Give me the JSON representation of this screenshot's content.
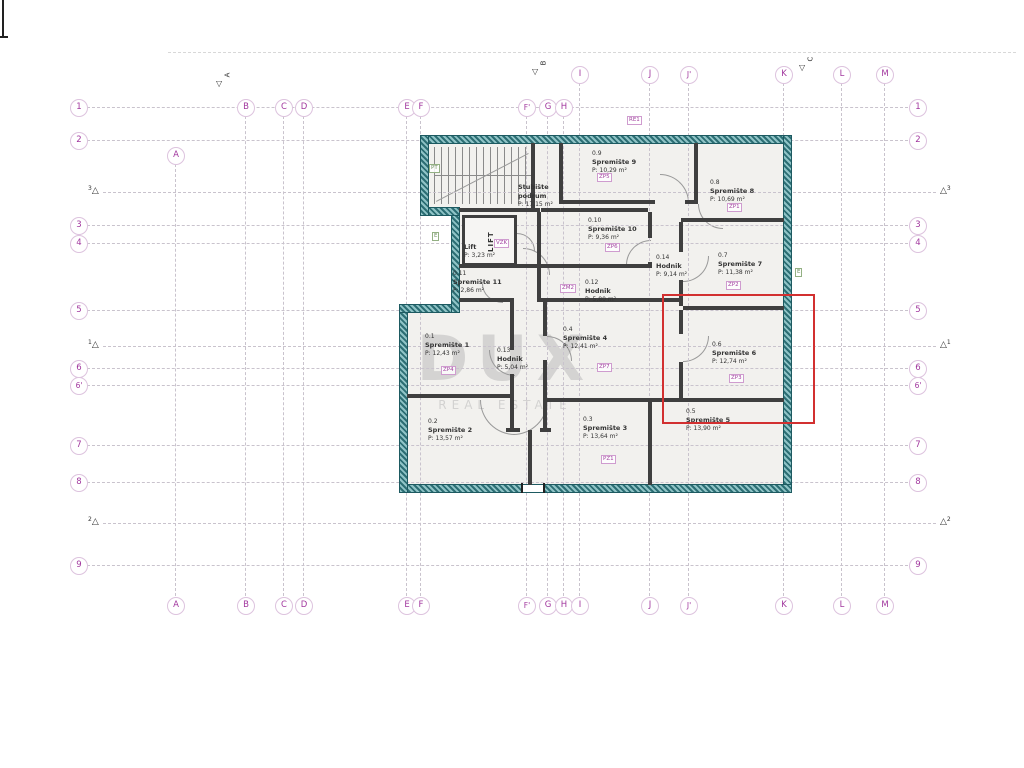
{
  "watermark": {
    "line1": "DUX",
    "line2": "REAL ESTATE"
  },
  "stairwell": {
    "line1": "Stubište",
    "line2": "podrum",
    "line3": "P: 17,15 m²"
  },
  "lift": {
    "name": "Lift",
    "area": "P: 3,23 m²",
    "shaft_label": "LIFT"
  },
  "highlight_color": "#d23030",
  "rooms": [
    {
      "id": "0.1",
      "name": "Spremište 1",
      "area": "P: 12,43 m²",
      "x": 425,
      "y": 333,
      "tag": "ZP4",
      "tx": 441,
      "ty": 366
    },
    {
      "id": "0.2",
      "name": "Spremište 2",
      "area": "P: 13,57 m²",
      "x": 428,
      "y": 418
    },
    {
      "id": "0.3",
      "name": "Spremište 3",
      "area": "P: 13,64 m²",
      "x": 583,
      "y": 416,
      "tag": "PZ1",
      "tx": 601,
      "ty": 455
    },
    {
      "id": "0.4",
      "name": "Spremište 4",
      "area": "P: 12,41 m²",
      "x": 563,
      "y": 326,
      "tag": "ZP7",
      "tx": 597,
      "ty": 363
    },
    {
      "id": "0.5",
      "name": "Spremište 5",
      "area": "P: 13,90 m²",
      "x": 686,
      "y": 408
    },
    {
      "id": "0.6",
      "name": "Spremište 6",
      "area": "P: 12,74 m²",
      "x": 712,
      "y": 341,
      "tag": "ZP3",
      "tx": 729,
      "ty": 374
    },
    {
      "id": "0.7",
      "name": "Spremište 7",
      "area": "P: 11,38 m²",
      "x": 718,
      "y": 252,
      "tag": "ZP2",
      "tx": 726,
      "ty": 281
    },
    {
      "id": "0.8",
      "name": "Spremište 8",
      "area": "P: 10,69 m²",
      "x": 710,
      "y": 179,
      "tag": "ZP1",
      "tx": 727,
      "ty": 203
    },
    {
      "id": "0.9",
      "name": "Spremište 9",
      "area": "P: 10,29 m²",
      "x": 592,
      "y": 150,
      "tag": "ZP5",
      "tx": 597,
      "ty": 173
    },
    {
      "id": "0.10",
      "name": "Spremište 10",
      "area": "P: 9,36 m²",
      "x": 588,
      "y": 217,
      "tag": "ZP6",
      "tx": 605,
      "ty": 243
    },
    {
      "id": "0.11",
      "name": "Spremište 11",
      "area": "P: 2,86 m²",
      "x": 453,
      "y": 270
    },
    {
      "id": "0.12",
      "name": "Hodnik",
      "area": "P: 5,80 m²",
      "x": 585,
      "y": 279
    },
    {
      "id": "0.13",
      "name": "Hodnik",
      "area": "P: 5,04 m²",
      "x": 497,
      "y": 347
    },
    {
      "id": "0.14",
      "name": "Hodnik",
      "area": "P: 9,14 m²",
      "x": 656,
      "y": 254
    }
  ],
  "wall_tags": [
    {
      "code": "RE1",
      "x": 627,
      "y": 116,
      "color": "purple"
    },
    {
      "code": "PT",
      "x": 429,
      "y": 164,
      "color": "green"
    },
    {
      "code": "E",
      "x": 432,
      "y": 232,
      "color": "green"
    },
    {
      "code": "ZM2",
      "x": 560,
      "y": 284,
      "color": "purple"
    },
    {
      "code": "VZK",
      "x": 494,
      "y": 239,
      "color": "purple"
    },
    {
      "code": "E",
      "x": 795,
      "y": 268,
      "color": "green"
    }
  ],
  "grid": {
    "columns": [
      {
        "label": "A",
        "x": 175,
        "top_y": 155
      },
      {
        "label": "B",
        "x": 245,
        "top_y": 107
      },
      {
        "label": "C",
        "x": 283,
        "top_y": 107
      },
      {
        "label": "D",
        "x": 303,
        "top_y": 107
      },
      {
        "label": "E",
        "x": 406,
        "top_y": 107
      },
      {
        "label": "F",
        "x": 420,
        "top_y": 107
      },
      {
        "label": "F'",
        "x": 526,
        "top_y": 107
      },
      {
        "label": "G",
        "x": 547,
        "top_y": 107
      },
      {
        "label": "H",
        "x": 563,
        "top_y": 107
      },
      {
        "label": "I",
        "x": 579,
        "top_y": 74
      },
      {
        "label": "J",
        "x": 649,
        "top_y": 74
      },
      {
        "label": "J'",
        "x": 688,
        "top_y": 74
      },
      {
        "label": "K",
        "x": 783,
        "top_y": 74
      },
      {
        "label": "L",
        "x": 841,
        "top_y": 74
      },
      {
        "label": "M",
        "x": 884,
        "top_y": 74
      }
    ],
    "bottom_y": 605,
    "rows": [
      {
        "label": "1",
        "y": 107
      },
      {
        "label": "2",
        "y": 140
      },
      {
        "label": "3",
        "y": 225
      },
      {
        "label": "4",
        "y": 243
      },
      {
        "label": "5",
        "y": 310
      },
      {
        "label": "6",
        "y": 368
      },
      {
        "label": "6'",
        "y": 385
      },
      {
        "label": "7",
        "y": 445
      },
      {
        "label": "8",
        "y": 482
      },
      {
        "label": "9",
        "y": 565
      }
    ],
    "sections": [
      {
        "label": "3",
        "y": 192
      },
      {
        "label": "1",
        "y": 346
      },
      {
        "label": "2",
        "y": 523
      }
    ],
    "view_markers": [
      {
        "label": "A",
        "x": 216,
        "y": 70
      },
      {
        "label": "B",
        "x": 532,
        "y": 58
      },
      {
        "label": "C",
        "x": 799,
        "y": 54
      }
    ]
  }
}
